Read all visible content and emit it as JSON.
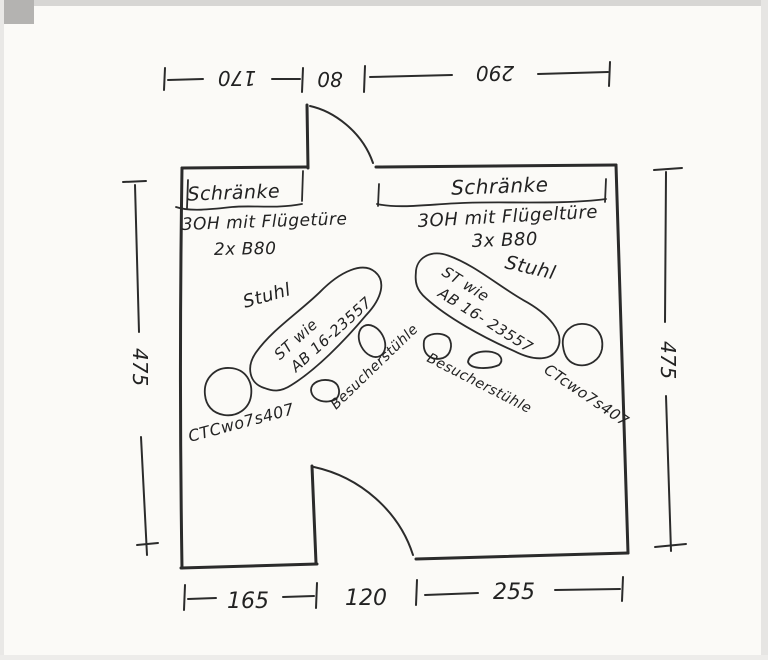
{
  "colors": {
    "ink": "#2b2b2b",
    "paper": "#fbfaf7"
  },
  "dims": {
    "top": [
      "170",
      "80",
      "290"
    ],
    "bottom": [
      "165",
      "120",
      "255"
    ],
    "left": "475",
    "right": "475"
  },
  "cabinets": [
    {
      "name": "Schränke",
      "desc": "3OH mit Flügetüre",
      "qty": "2x B80"
    },
    {
      "name": "Schränke",
      "desc": "3OH mit Flügeltüre",
      "qty": "3x B80"
    }
  ],
  "desks": [
    {
      "line1": "ST wie",
      "line2": "AB 16-23557"
    },
    {
      "line1": "ST wie",
      "line2": "AB 16- 23557"
    }
  ],
  "labels": {
    "chair_left": "Stuhl",
    "chair_right": "Stuhl",
    "visitor_left": "Besucherstühle",
    "visitor_right": "Besucherstühle",
    "code_left": "CTCwo7s407",
    "code_right": "CTcwo7s407"
  }
}
